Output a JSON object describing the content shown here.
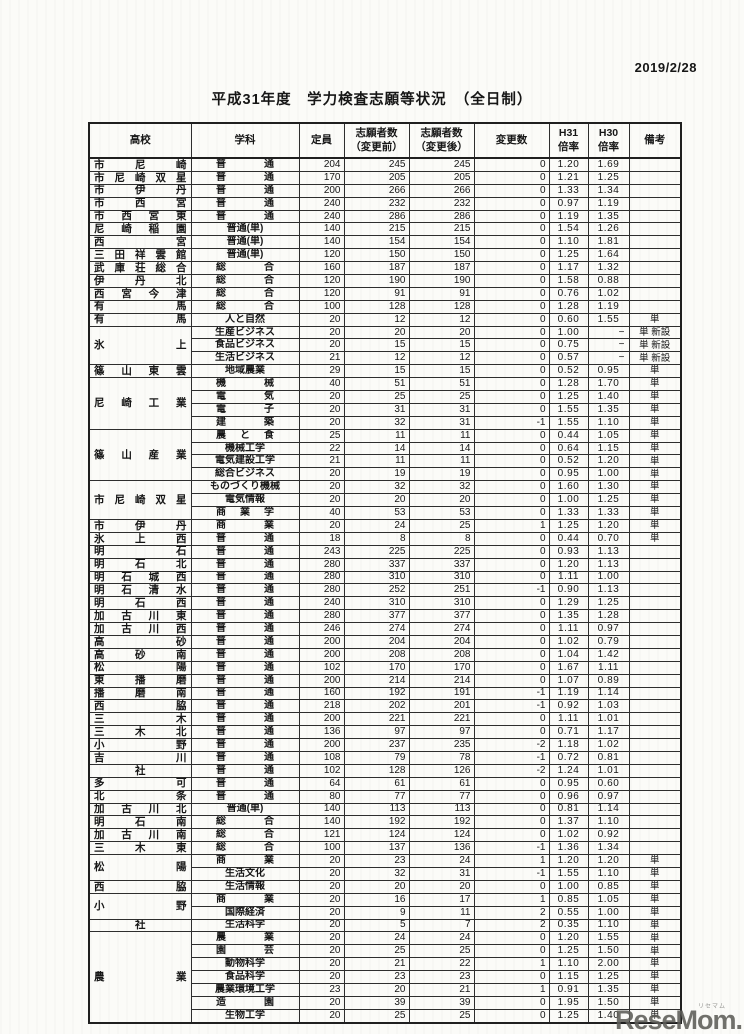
{
  "page": {
    "date": "2019/2/28",
    "title": "平成31年度　学力検査志願等状況　（全日制）"
  },
  "table": {
    "headers": {
      "school": "高校",
      "dept": "学科",
      "capacity": "定員",
      "before": "志願者数\n（変更前）",
      "after": "志願者数\n（変更後）",
      "change": "変更数",
      "h31": "H31\n倍率",
      "h30": "H30\n倍率",
      "remark": "備考"
    },
    "rows": [
      {
        "school": "市尼崎",
        "span": 1,
        "dept": "普通",
        "capacity": 204,
        "before": 245,
        "after": 245,
        "change": 0,
        "h31": "1.20",
        "h30": "1.69",
        "remark": ""
      },
      {
        "school": "市尼崎双星",
        "span": 1,
        "dept": "普通",
        "capacity": 170,
        "before": 205,
        "after": 205,
        "change": 0,
        "h31": "1.21",
        "h30": "1.25",
        "remark": ""
      },
      {
        "school": "市伊丹",
        "span": 1,
        "dept": "普通",
        "capacity": 200,
        "before": 266,
        "after": 266,
        "change": 0,
        "h31": "1.33",
        "h30": "1.34",
        "remark": ""
      },
      {
        "school": "市西宮",
        "span": 1,
        "dept": "普通",
        "capacity": 240,
        "before": 232,
        "after": 232,
        "change": 0,
        "h31": "0.97",
        "h30": "1.19",
        "remark": ""
      },
      {
        "school": "市西宮東",
        "span": 1,
        "dept": "普通",
        "capacity": 240,
        "before": 286,
        "after": 286,
        "change": 0,
        "h31": "1.19",
        "h30": "1.35",
        "remark": ""
      },
      {
        "school": "尼崎稲園",
        "span": 1,
        "dept": "普通(単)",
        "capacity": 140,
        "before": 215,
        "after": 215,
        "change": 0,
        "h31": "1.54",
        "h30": "1.26",
        "remark": ""
      },
      {
        "school": "西宮",
        "span": 1,
        "dept": "普通(単)",
        "capacity": 140,
        "before": 154,
        "after": 154,
        "change": 0,
        "h31": "1.10",
        "h30": "1.81",
        "remark": ""
      },
      {
        "school": "三田祥雲館",
        "span": 1,
        "dept": "普通(単)",
        "capacity": 120,
        "before": 150,
        "after": 150,
        "change": 0,
        "h31": "1.25",
        "h30": "1.64",
        "remark": ""
      },
      {
        "school": "武庫荘総合",
        "span": 1,
        "dept": "総合",
        "capacity": 160,
        "before": 187,
        "after": 187,
        "change": 0,
        "h31": "1.17",
        "h30": "1.32",
        "remark": ""
      },
      {
        "school": "伊丹北",
        "span": 1,
        "dept": "総合",
        "capacity": 120,
        "before": 190,
        "after": 190,
        "change": 0,
        "h31": "1.58",
        "h30": "0.88",
        "remark": ""
      },
      {
        "school": "西宮今津",
        "span": 1,
        "dept": "総合",
        "capacity": 120,
        "before": 91,
        "after": 91,
        "change": 0,
        "h31": "0.76",
        "h30": "1.02",
        "remark": ""
      },
      {
        "school": "有馬",
        "span": 1,
        "dept": "総合",
        "capacity": 100,
        "before": 128,
        "after": 128,
        "change": 0,
        "h31": "1.28",
        "h30": "1.19",
        "remark": ""
      },
      {
        "school": "有馬",
        "span": 1,
        "dept": "人と自然",
        "capacity": 20,
        "before": 12,
        "after": 12,
        "change": 0,
        "h31": "0.60",
        "h30": "1.55",
        "remark": "単"
      },
      {
        "school": "氷上",
        "span": 3,
        "dept": "生産ビジネス",
        "capacity": 20,
        "before": 20,
        "after": 20,
        "change": 0,
        "h31": "1.00",
        "h30": "−",
        "remark": "単 新設"
      },
      {
        "dept": "食品ビジネス",
        "capacity": 20,
        "before": 15,
        "after": 15,
        "change": 0,
        "h31": "0.75",
        "h30": "−",
        "remark": "単 新設"
      },
      {
        "dept": "生活ビジネス",
        "capacity": 21,
        "before": 12,
        "after": 12,
        "change": 0,
        "h31": "0.57",
        "h30": "−",
        "remark": "単 新設"
      },
      {
        "school": "篠山東雲",
        "span": 1,
        "dept": "地域農業",
        "capacity": 29,
        "before": 15,
        "after": 15,
        "change": 0,
        "h31": "0.52",
        "h30": "0.95",
        "remark": "単"
      },
      {
        "school": "尼崎工業",
        "span": 4,
        "dept": "機械",
        "capacity": 40,
        "before": 51,
        "after": 51,
        "change": 0,
        "h31": "1.28",
        "h30": "1.70",
        "remark": "単"
      },
      {
        "dept": "電気",
        "capacity": 20,
        "before": 25,
        "after": 25,
        "change": 0,
        "h31": "1.25",
        "h30": "1.40",
        "remark": "単"
      },
      {
        "dept": "電子",
        "capacity": 20,
        "before": 31,
        "after": 31,
        "change": 0,
        "h31": "1.55",
        "h30": "1.35",
        "remark": "単"
      },
      {
        "dept": "建築",
        "capacity": 20,
        "before": 32,
        "after": 31,
        "change": -1,
        "h31": "1.55",
        "h30": "1.10",
        "remark": "単"
      },
      {
        "school": "篠山産業",
        "span": 4,
        "dept": "農と食",
        "capacity": 25,
        "before": 11,
        "after": 11,
        "change": 0,
        "h31": "0.44",
        "h30": "1.05",
        "remark": "単"
      },
      {
        "dept": "機械工学",
        "capacity": 22,
        "before": 14,
        "after": 14,
        "change": 0,
        "h31": "0.64",
        "h30": "1.15",
        "remark": "単"
      },
      {
        "dept": "電気建設工学",
        "capacity": 21,
        "before": 11,
        "after": 11,
        "change": 0,
        "h31": "0.52",
        "h30": "1.20",
        "remark": "単"
      },
      {
        "dept": "総合ビジネス",
        "capacity": 20,
        "before": 19,
        "after": 19,
        "change": 0,
        "h31": "0.95",
        "h30": "1.00",
        "remark": "単"
      },
      {
        "school": "市尼崎双星",
        "span": 3,
        "dept": "ものづくり機械",
        "capacity": 20,
        "before": 32,
        "after": 32,
        "change": 0,
        "h31": "1.60",
        "h30": "1.30",
        "remark": "単"
      },
      {
        "dept": "電気情報",
        "capacity": 20,
        "before": 20,
        "after": 20,
        "change": 0,
        "h31": "1.00",
        "h30": "1.25",
        "remark": "単"
      },
      {
        "dept": "商業学",
        "capacity": 40,
        "before": 53,
        "after": 53,
        "change": 0,
        "h31": "1.33",
        "h30": "1.33",
        "remark": "単"
      },
      {
        "school": "市伊丹",
        "span": 1,
        "dept": "商業",
        "capacity": 20,
        "before": 24,
        "after": 25,
        "change": 1,
        "h31": "1.25",
        "h30": "1.20",
        "remark": "単"
      },
      {
        "school": "氷上西",
        "span": 1,
        "dept": "普通",
        "capacity": 18,
        "before": 8,
        "after": 8,
        "change": 0,
        "h31": "0.44",
        "h30": "0.70",
        "remark": "単"
      },
      {
        "school": "明石",
        "span": 1,
        "dept": "普通",
        "capacity": 243,
        "before": 225,
        "after": 225,
        "change": 0,
        "h31": "0.93",
        "h30": "1.13",
        "remark": ""
      },
      {
        "school": "明石北",
        "span": 1,
        "dept": "普通",
        "capacity": 280,
        "before": 337,
        "after": 337,
        "change": 0,
        "h31": "1.20",
        "h30": "1.13",
        "remark": ""
      },
      {
        "school": "明石城西",
        "span": 1,
        "dept": "普通",
        "capacity": 280,
        "before": 310,
        "after": 310,
        "change": 0,
        "h31": "1.11",
        "h30": "1.00",
        "remark": ""
      },
      {
        "school": "明石清水",
        "span": 1,
        "dept": "普通",
        "capacity": 280,
        "before": 252,
        "after": 251,
        "change": -1,
        "h31": "0.90",
        "h30": "1.13",
        "remark": ""
      },
      {
        "school": "明石西",
        "span": 1,
        "dept": "普通",
        "capacity": 240,
        "before": 310,
        "after": 310,
        "change": 0,
        "h31": "1.29",
        "h30": "1.25",
        "remark": ""
      },
      {
        "school": "加古川東",
        "span": 1,
        "dept": "普通",
        "capacity": 280,
        "before": 377,
        "after": 377,
        "change": 0,
        "h31": "1.35",
        "h30": "1.28",
        "remark": ""
      },
      {
        "school": "加古川西",
        "span": 1,
        "dept": "普通",
        "capacity": 246,
        "before": 274,
        "after": 274,
        "change": 0,
        "h31": "1.11",
        "h30": "0.97",
        "remark": ""
      },
      {
        "school": "高砂",
        "span": 1,
        "dept": "普通",
        "capacity": 200,
        "before": 204,
        "after": 204,
        "change": 0,
        "h31": "1.02",
        "h30": "0.79",
        "remark": ""
      },
      {
        "school": "高砂南",
        "span": 1,
        "dept": "普通",
        "capacity": 200,
        "before": 208,
        "after": 208,
        "change": 0,
        "h31": "1.04",
        "h30": "1.42",
        "remark": ""
      },
      {
        "school": "松陽",
        "span": 1,
        "dept": "普通",
        "capacity": 102,
        "before": 170,
        "after": 170,
        "change": 0,
        "h31": "1.67",
        "h30": "1.11",
        "remark": ""
      },
      {
        "school": "東播磨",
        "span": 1,
        "dept": "普通",
        "capacity": 200,
        "before": 214,
        "after": 214,
        "change": 0,
        "h31": "1.07",
        "h30": "0.89",
        "remark": ""
      },
      {
        "school": "播磨南",
        "span": 1,
        "dept": "普通",
        "capacity": 160,
        "before": 192,
        "after": 191,
        "change": -1,
        "h31": "1.19",
        "h30": "1.14",
        "remark": ""
      },
      {
        "school": "西脇",
        "span": 1,
        "dept": "普通",
        "capacity": 218,
        "before": 202,
        "after": 201,
        "change": -1,
        "h31": "0.92",
        "h30": "1.03",
        "remark": ""
      },
      {
        "school": "三木",
        "span": 1,
        "dept": "普通",
        "capacity": 200,
        "before": 221,
        "after": 221,
        "change": 0,
        "h31": "1.11",
        "h30": "1.01",
        "remark": ""
      },
      {
        "school": "三木北",
        "span": 1,
        "dept": "普通",
        "capacity": 136,
        "before": 97,
        "after": 97,
        "change": 0,
        "h31": "0.71",
        "h30": "1.17",
        "remark": ""
      },
      {
        "school": "小野",
        "span": 1,
        "dept": "普通",
        "capacity": 200,
        "before": 237,
        "after": 235,
        "change": -2,
        "h31": "1.18",
        "h30": "1.02",
        "remark": ""
      },
      {
        "school": "吉川",
        "span": 1,
        "dept": "普通",
        "capacity": 108,
        "before": 79,
        "after": 78,
        "change": -1,
        "h31": "0.72",
        "h30": "0.81",
        "remark": ""
      },
      {
        "school": "社",
        "span": 1,
        "dept": "普通",
        "capacity": 102,
        "before": 128,
        "after": 126,
        "change": -2,
        "h31": "1.24",
        "h30": "1.01",
        "remark": ""
      },
      {
        "school": "多可",
        "span": 1,
        "dept": "普通",
        "capacity": 64,
        "before": 61,
        "after": 61,
        "change": 0,
        "h31": "0.95",
        "h30": "0.60",
        "remark": ""
      },
      {
        "school": "北条",
        "span": 1,
        "dept": "普通",
        "capacity": 80,
        "before": 77,
        "after": 77,
        "change": 0,
        "h31": "0.96",
        "h30": "0.97",
        "remark": ""
      },
      {
        "school": "加古川北",
        "span": 1,
        "dept": "普通(単)",
        "capacity": 140,
        "before": 113,
        "after": 113,
        "change": 0,
        "h31": "0.81",
        "h30": "1.14",
        "remark": ""
      },
      {
        "school": "明石南",
        "span": 1,
        "dept": "総合",
        "capacity": 140,
        "before": 192,
        "after": 192,
        "change": 0,
        "h31": "1.37",
        "h30": "1.10",
        "remark": ""
      },
      {
        "school": "加古川南",
        "span": 1,
        "dept": "総合",
        "capacity": 121,
        "before": 124,
        "after": 124,
        "change": 0,
        "h31": "1.02",
        "h30": "0.92",
        "remark": ""
      },
      {
        "school": "三木東",
        "span": 1,
        "dept": "総合",
        "capacity": 100,
        "before": 137,
        "after": 136,
        "change": -1,
        "h31": "1.36",
        "h30": "1.34",
        "remark": ""
      },
      {
        "school": "松陽",
        "span": 2,
        "dept": "商業",
        "capacity": 20,
        "before": 23,
        "after": 24,
        "change": 1,
        "h31": "1.20",
        "h30": "1.20",
        "remark": "単"
      },
      {
        "dept": "生活文化",
        "capacity": 20,
        "before": 32,
        "after": 31,
        "change": -1,
        "h31": "1.55",
        "h30": "1.10",
        "remark": "単"
      },
      {
        "school": "西脇",
        "span": 1,
        "dept": "生活情報",
        "capacity": 20,
        "before": 20,
        "after": 20,
        "change": 0,
        "h31": "1.00",
        "h30": "0.85",
        "remark": "単"
      },
      {
        "school": "小野",
        "span": 2,
        "dept": "商業",
        "capacity": 20,
        "before": 16,
        "after": 17,
        "change": 1,
        "h31": "0.85",
        "h30": "1.05",
        "remark": "単"
      },
      {
        "dept": "国際経済",
        "capacity": 20,
        "before": 9,
        "after": 11,
        "change": 2,
        "h31": "0.55",
        "h30": "1.00",
        "remark": "単"
      },
      {
        "school": "社",
        "span": 1,
        "dept": "生活科学",
        "capacity": 20,
        "before": 5,
        "after": 7,
        "change": 2,
        "h31": "0.35",
        "h30": "1.10",
        "remark": "単"
      },
      {
        "school": "農業",
        "span": 7,
        "dept": "農業",
        "capacity": 20,
        "before": 24,
        "after": 24,
        "change": 0,
        "h31": "1.20",
        "h30": "1.55",
        "remark": "単"
      },
      {
        "dept": "園芸",
        "capacity": 20,
        "before": 25,
        "after": 25,
        "change": 0,
        "h31": "1.25",
        "h30": "1.50",
        "remark": "単"
      },
      {
        "dept": "動物科学",
        "capacity": 20,
        "before": 21,
        "after": 22,
        "change": 1,
        "h31": "1.10",
        "h30": "2.00",
        "remark": "単"
      },
      {
        "dept": "食品科学",
        "capacity": 20,
        "before": 23,
        "after": 23,
        "change": 0,
        "h31": "1.15",
        "h30": "1.25",
        "remark": "単"
      },
      {
        "dept": "農業環境工学",
        "capacity": 23,
        "before": 20,
        "after": 21,
        "change": 1,
        "h31": "0.91",
        "h30": "1.35",
        "remark": "単"
      },
      {
        "dept": "造園",
        "capacity": 20,
        "before": 39,
        "after": 39,
        "change": 0,
        "h31": "1.95",
        "h30": "1.50",
        "remark": "単"
      },
      {
        "dept": "生物工学",
        "capacity": 20,
        "before": 25,
        "after": 25,
        "change": 0,
        "h31": "1.25",
        "h30": "1.40",
        "remark": "単"
      }
    ]
  },
  "watermark": {
    "text": "ReseMom.",
    "ruby": "リセマム"
  }
}
